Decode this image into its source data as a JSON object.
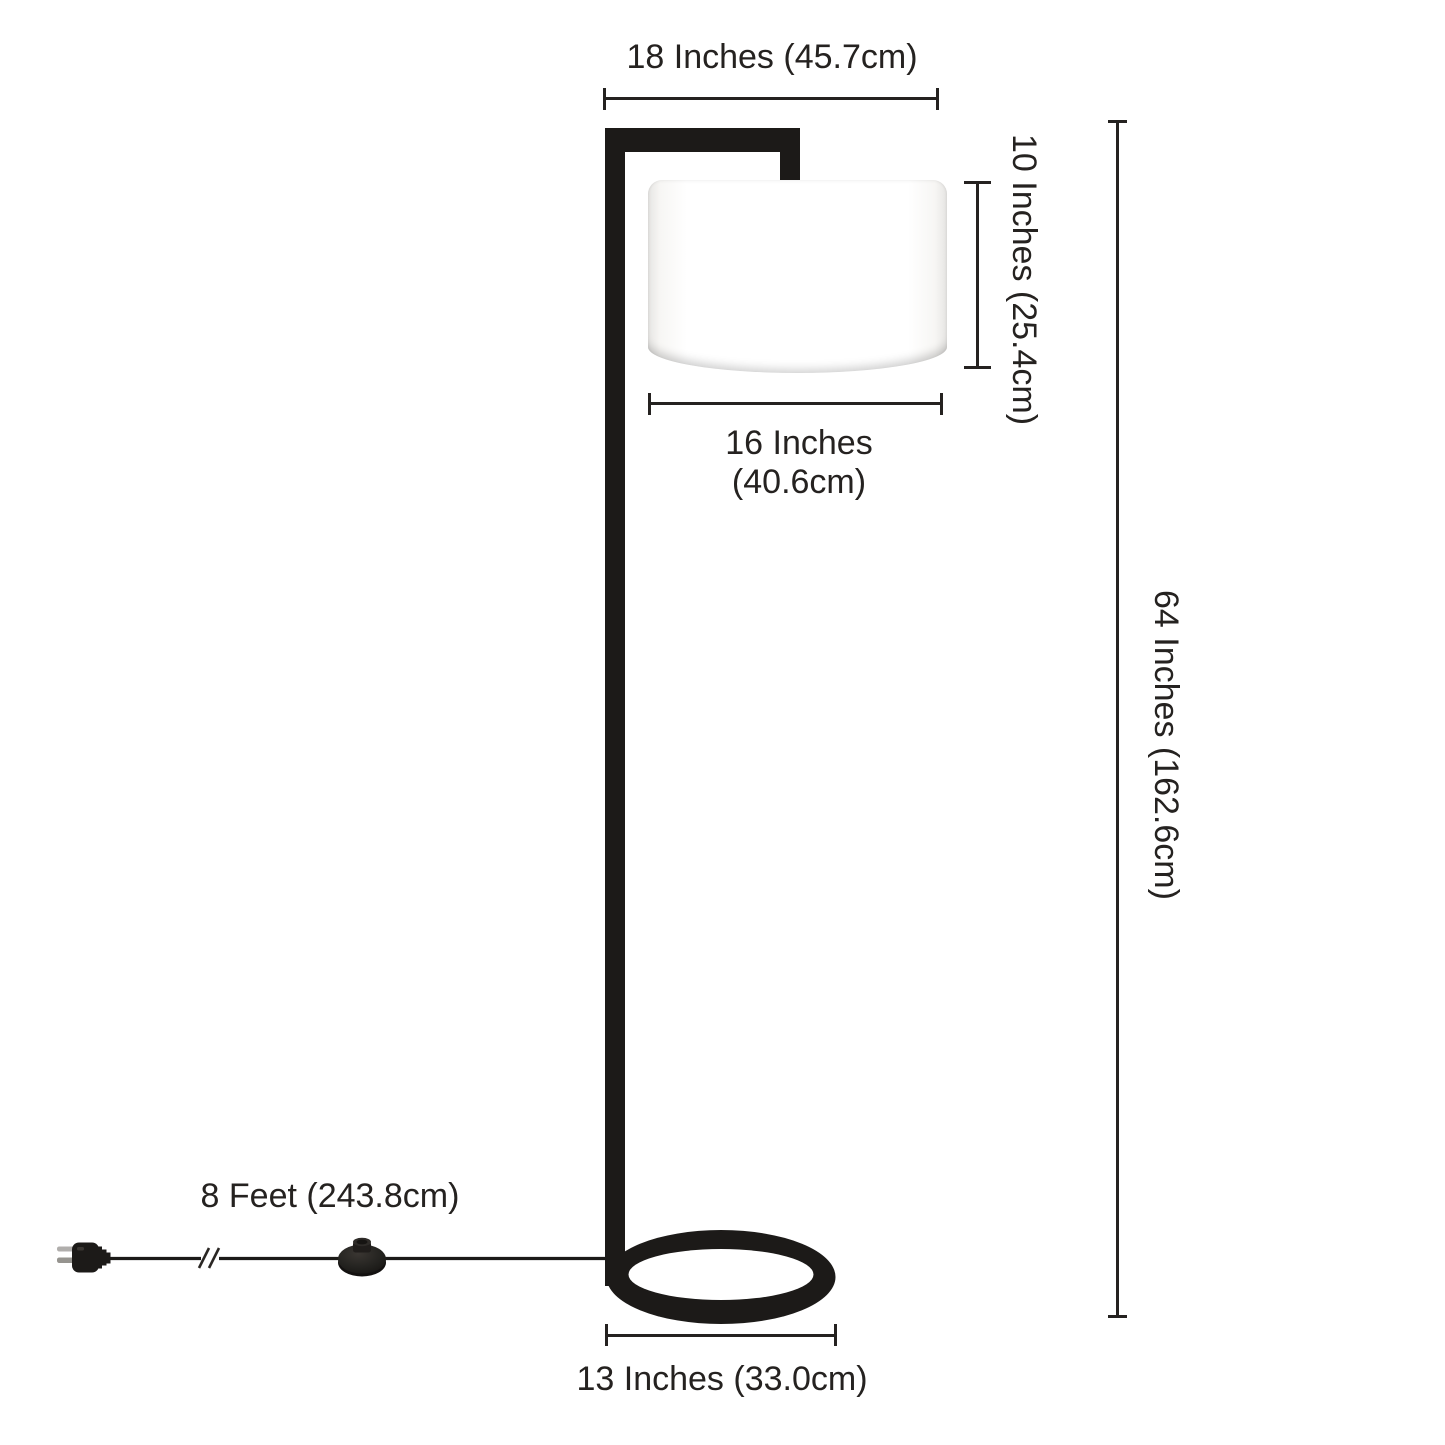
{
  "diagram": {
    "subject": "floor-lamp-dimension-diagram",
    "dims": {
      "arm_width": {
        "inches": 18,
        "cm": 45.7,
        "label": "18 Inches (45.7cm)"
      },
      "shade_height": {
        "inches": 10,
        "cm": 25.4,
        "label": "10 Inches (25.4cm)"
      },
      "shade_width": {
        "inches": 16,
        "cm": 40.6,
        "line1": "16 Inches",
        "line2": "(40.6cm)"
      },
      "total_height": {
        "inches": 64,
        "cm": 162.6,
        "label": "64 Inches (162.6cm)"
      },
      "cord_length": {
        "feet": 8,
        "cm": 243.8,
        "label": "8 Feet (243.8cm)"
      },
      "base_width": {
        "inches": 13,
        "cm": 33.0,
        "label": "13 Inches (33.0cm)"
      }
    }
  },
  "colors": {
    "frame": "#1c1a18",
    "dimension": "#252220",
    "shade": "#ffffff",
    "shade_edge": "#e6e5e3",
    "background": "#ffffff",
    "prong": "#a8a6a4"
  }
}
